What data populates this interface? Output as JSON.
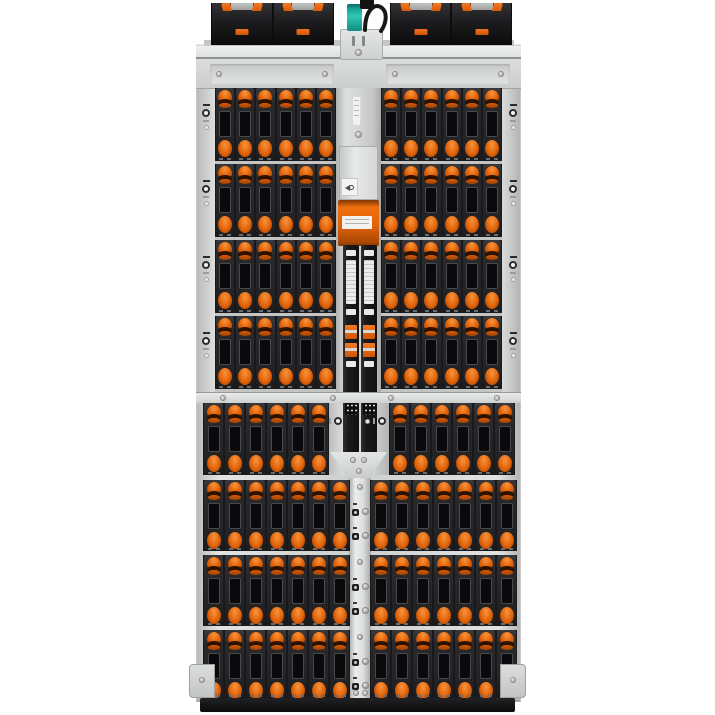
{
  "scene": {
    "type": "product-photograph",
    "subject": "High-density storage server enclosure, top-down view",
    "background_color": "#ffffff"
  },
  "colors": {
    "accent_orange": "#e8651a",
    "latch_orange_dark": "#8a3502",
    "chassis_silver": "#d6d8d7",
    "drive_body_black": "#28282a",
    "sled_module_black": "#141416",
    "teal_connector": "#1fae9f",
    "bottom_bar_black": "#18181a"
  },
  "enclosure": {
    "top_row": {
      "sled_modules_total": 4,
      "modules_per_side": 2,
      "orange_tabs_per_module": 2,
      "orange_clip_per_module": 1,
      "center_connector": "teal-connector",
      "center_cable": "black-looped-cable"
    },
    "drive_grid": {
      "upper_section": {
        "rows": 4,
        "left_columns": 6,
        "right_columns": 6,
        "carriers": 48
      },
      "lower_section": {
        "rows": [
          {
            "left_columns": 6,
            "right_columns": 6
          },
          {
            "left_columns": 7,
            "right_columns": 7
          },
          {
            "left_columns": 7,
            "right_columns": 7
          },
          {
            "left_columns": 7,
            "right_columns": 7
          }
        ],
        "carriers": 54
      },
      "total_visible_carriers": 102
    },
    "center_spine": {
      "orange_module_count": 1,
      "black_cable_rails": 2,
      "orange_cable_clips_per_rail": 2,
      "white_label_stickers": 6,
      "labels_readable": false,
      "thin_spine_lock_screw_pairs": 6
    },
    "fasteners": {
      "left_rail_thumbscrew_icons": 4,
      "right_rail_thumbscrew_icons": 4,
      "rotated_spine_icons": 2
    },
    "bottom": {
      "black_base_bar": true,
      "corner_brackets": 2
    }
  }
}
